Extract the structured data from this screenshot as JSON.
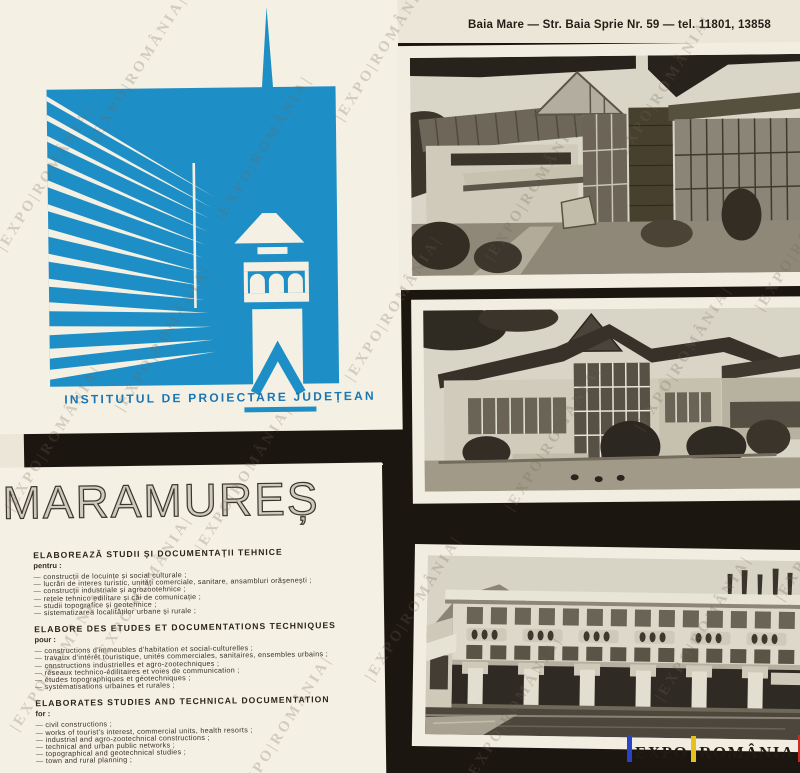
{
  "page": {
    "background": "#ebe6d7",
    "black": "#1c1611"
  },
  "header": {
    "address": "Baia Mare — Str. Baia Sprie Nr. 59 — tel. 11801, 13858"
  },
  "logo": {
    "institute": "INSTITUTUL DE PROIECTARE JUDEȚEAN",
    "blue": "#1e8fc6"
  },
  "title": {
    "text": "MARAMUREȘ"
  },
  "sections": [
    {
      "heading": "ELABOREAZĂ STUDII ȘI DOCUMENTAȚII TEHNICE",
      "intro": "pentru :",
      "items": [
        "— construcții de locuințe și social culturale ;",
        "— lucrări de interes turistic, unități comerciale, sanitare, ansambluri orășenești ;",
        "— construcții industriale și agrozootehnice ;",
        "— rețele tehnico edilitare și căi de comunicație ;",
        "— studii topografice și geotehnice ;",
        "— sistematizarea localităților urbane și rurale ;"
      ]
    },
    {
      "heading": "ELABORE DES ETUDES ET DOCUMENTATIONS TECHNIQUES",
      "intro": "pour :",
      "items": [
        "— constructions d'immeubles d'habitation et social-culturelles ;",
        "— travaux d'intérêt touristique, unités commerciales, sanitaires, ensembles urbains ;",
        "— constructions industrielles et agro-zootechniques ;",
        "— réseaux technico-édilitaires et voies de communication ;",
        "— études topographiques et géotechniques ;",
        "— systématisations urbaines et rurales ;"
      ]
    },
    {
      "heading": "ELABORATES STUDIES AND TECHNICAL DOCUMENTATION",
      "intro": "for :",
      "items": [
        "— civil constructions ;",
        "— works of tourist's interest, commercial units, health resorts ;",
        "— industrial and agro-zootechnical constructions ;",
        "— technical and urban public networks ;",
        "— topographical and geotechnical studies ;",
        "— town and rural planning ;"
      ]
    }
  ],
  "badge": {
    "left": "EXPO",
    "right": "ROMÂNIA",
    "bar_colors": [
      "#2a41c8",
      "#e6c31c",
      "#d2271c"
    ]
  },
  "watermark": {
    "text": "|EXPO|ROMÂNIA|"
  }
}
